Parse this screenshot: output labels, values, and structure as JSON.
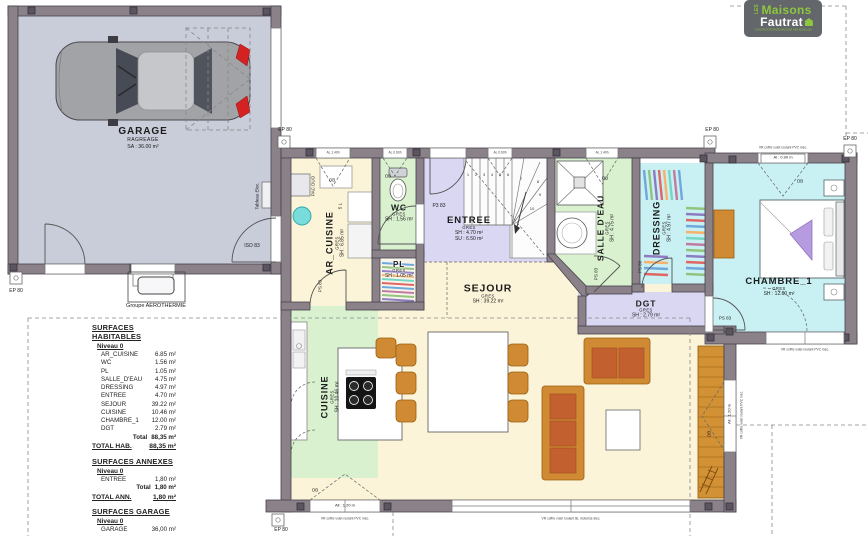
{
  "logo": {
    "les": "LES",
    "name1": "Maisons",
    "name2": "Fautrat",
    "tagline": "CONSTRUCTEUR DE MAISONS INDIVIDUELLES",
    "accent_green": "#8dc63f",
    "gray": "#63666a"
  },
  "garage": {
    "name": "GARAGE",
    "finish": "RAGREAGE",
    "area": "SA : 36.00 m²",
    "aerothermie": "Groupe AEROTHERMIE"
  },
  "rooms": {
    "ar_cuisine": {
      "name": "AR_CUISINE",
      "floor": "GRES",
      "sh": "SH : 6.85 m²"
    },
    "wc": {
      "name": "WC",
      "floor": "GRES",
      "sh": "SH : 1.56 m²"
    },
    "pl": {
      "name": "PL",
      "floor": "GRES",
      "sh": "SH : 1.05 m²"
    },
    "entree": {
      "name": "ENTREE",
      "floor": "GRES",
      "sh": "SH : 4.70 m²",
      "su": "SU : 6.50 m²"
    },
    "salle_deau": {
      "name": "SALLE D'EAU",
      "floor": "GRES",
      "sh": "SH : 4.75 m²"
    },
    "dressing": {
      "name": "DRESSING",
      "floor": "GRES",
      "sh": "SH : 4.97 m²"
    },
    "sejour": {
      "name": "SEJOUR",
      "floor": "GRES",
      "sh": "SH : 39.22 m²"
    },
    "cuisine": {
      "name": "CUISINE",
      "floor": "GRES",
      "sh": "SH : 10.46 m²"
    },
    "dgt": {
      "name": "DGT",
      "floor": "GRES",
      "sh": "SH : 2.79 m²"
    },
    "chambre1": {
      "name": "CHAMBRE_1",
      "floor": "GRES",
      "sh": "SH : 12.00 m²"
    }
  },
  "annotations": {
    "ep": "EP 80",
    "iso": "ISO 83",
    "ps": "PS 83",
    "p3": "P3 83",
    "ob": "OB",
    "pac": "PAC DUO",
    "five_l": "5 L",
    "tableau": "Tableau Elec."
  },
  "window_labels": {
    "w_140": "AL 1.40h",
    "w_060": "AL 0.60h",
    "w_090": "Al : 0.90 m",
    "w_120": "All : 1.20 m",
    "vr_pvc": "VR coffre volet roulant PVC méc.",
    "vr_bl": "VR coffre volet roulant BL motorisé élec."
  },
  "stairs": [
    "1",
    "2",
    "3",
    "4",
    "5",
    "6",
    "7",
    "8",
    "9",
    "10"
  ],
  "tables": {
    "habitables": {
      "title": "SURFACES HABITABLES",
      "level": "Niveau 0",
      "rows": [
        [
          "AR_CUISINE",
          "6.85 m²"
        ],
        [
          "WC",
          "1.56 m²"
        ],
        [
          "PL",
          "1.05 m²"
        ],
        [
          "SALLE_D'EAU",
          "4.75 m²"
        ],
        [
          "DRESSING",
          "4.97 m²"
        ],
        [
          "ENTREE",
          "4.70 m²"
        ],
        [
          "SEJOUR",
          "39.22 m²"
        ],
        [
          "CUISINE",
          "10.46 m²"
        ],
        [
          "CHAMBRE_1",
          "12.00 m²"
        ],
        [
          "DGT",
          "2.79 m²"
        ]
      ],
      "total_label": "Total",
      "total_value": "88,35 m²",
      "grand_label": "TOTAL HAB.",
      "grand_value": "88,35 m²"
    },
    "annexes": {
      "title": "SURFACES ANNEXES",
      "level": "Niveau 0",
      "rows": [
        [
          "ENTREE",
          "1,80 m²"
        ]
      ],
      "total_label": "Total",
      "total_value": "1,80 m²",
      "grand_label": "TOTAL ANN.",
      "grand_value": "1,80 m²"
    },
    "garage": {
      "title": "SURFACES GARAGE",
      "level": "Niveau 0",
      "rows": [
        [
          "GARAGE",
          "36,00 m²"
        ]
      ]
    }
  },
  "colors": {
    "wall": "#8b8289",
    "garage_floor": "#c9ccd9",
    "cream": "#fbf4d8",
    "green": "#d9f1cf",
    "lavender": "#dad7f3",
    "cyan": "#c9f0f3",
    "pl_floor": "#f7f4ea",
    "deck": "#d29134",
    "furn_orange": "#cf8a33",
    "furn_rust": "#c2602f",
    "ballon_cyan": "#77dcdb"
  }
}
